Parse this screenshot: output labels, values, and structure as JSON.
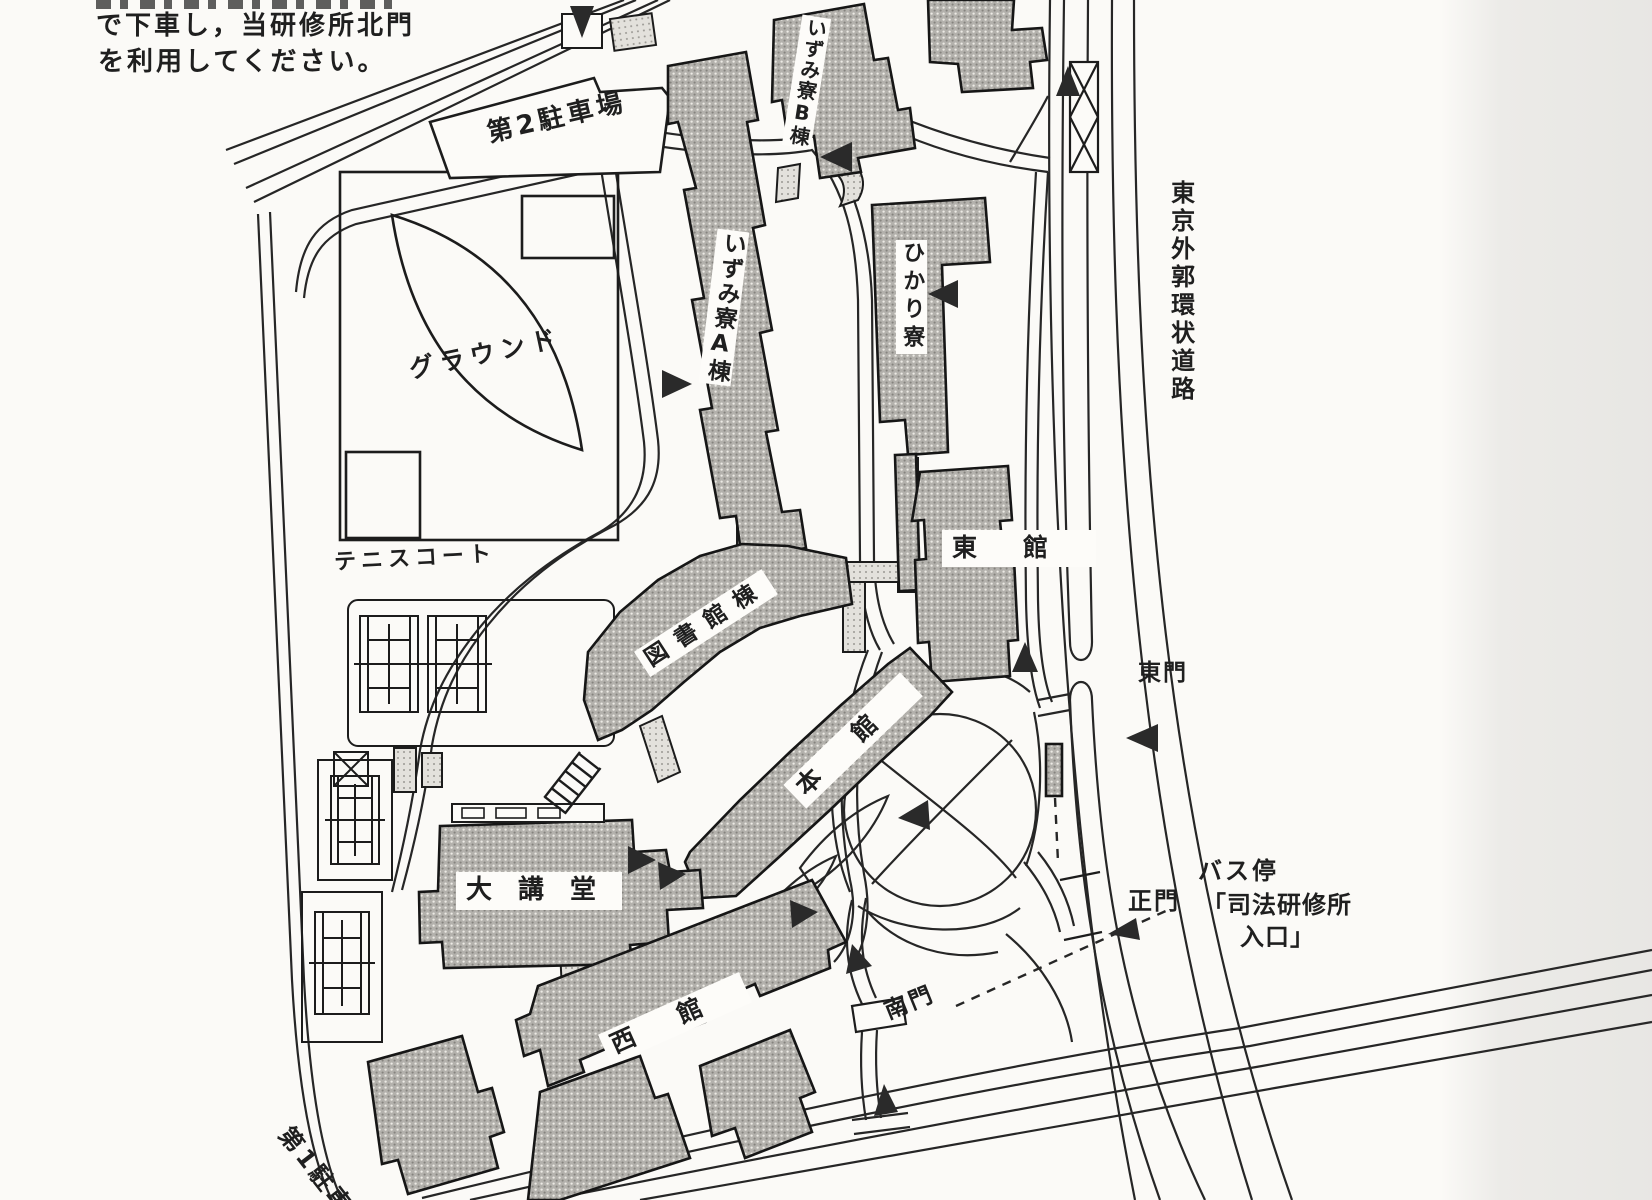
{
  "note": {
    "line1": "で下車し，当研修所北門",
    "line2": "を利用してください。"
  },
  "labels": {
    "parking2": "第2駐車場",
    "ground": "グラウンド",
    "tennis": "テニスコート",
    "izumi_b": "いずみ寮B棟",
    "izumi_a": "いずみ寮A棟",
    "hikari": "ひかり寮",
    "east_bldg": "東館",
    "library": "図書館棟",
    "main_bldg": "本館",
    "auditorium": "大講堂",
    "west_bldg": "西館",
    "ring_road": "東京外郭環状道路",
    "east_gate": "東門",
    "main_gate": "正門",
    "south_gate": "南門",
    "bus_stop_line1": "バス停",
    "bus_stop_line2": "「司法研修所",
    "bus_stop_line3": "入口」",
    "parking1": "第1駐車場"
  },
  "colors": {
    "paper": "#fbfaf7",
    "ink": "#1f1f1f",
    "building_fill": "#b3b1ac",
    "corridor_fill": "#d8d6d1"
  }
}
